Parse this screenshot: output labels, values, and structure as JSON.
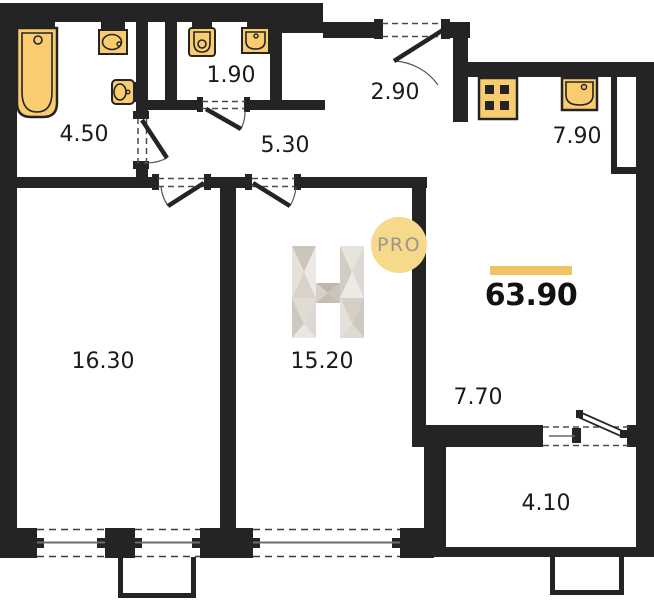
{
  "plan": {
    "total_area": "63.90",
    "watermark": {
      "letter": "H",
      "badge": "PRO"
    },
    "rooms": [
      {
        "name": "bathroom",
        "area": "4.50"
      },
      {
        "name": "wc",
        "area": "1.90"
      },
      {
        "name": "hallway",
        "area": "5.30"
      },
      {
        "name": "entry",
        "area": "2.90"
      },
      {
        "name": "kitchen",
        "area": "7.90"
      },
      {
        "name": "living-room",
        "area": "16.30"
      },
      {
        "name": "bedroom",
        "area": "15.20"
      },
      {
        "name": "corridor",
        "area": "7.70"
      },
      {
        "name": "balcony",
        "area": "4.10"
      }
    ],
    "colors": {
      "wall": "#242424",
      "fixture_fill": "#F9CD6F",
      "accent_bar": "#EFC262",
      "badge_fill": "#F6D98A",
      "badge_text": "#9B968E"
    }
  }
}
